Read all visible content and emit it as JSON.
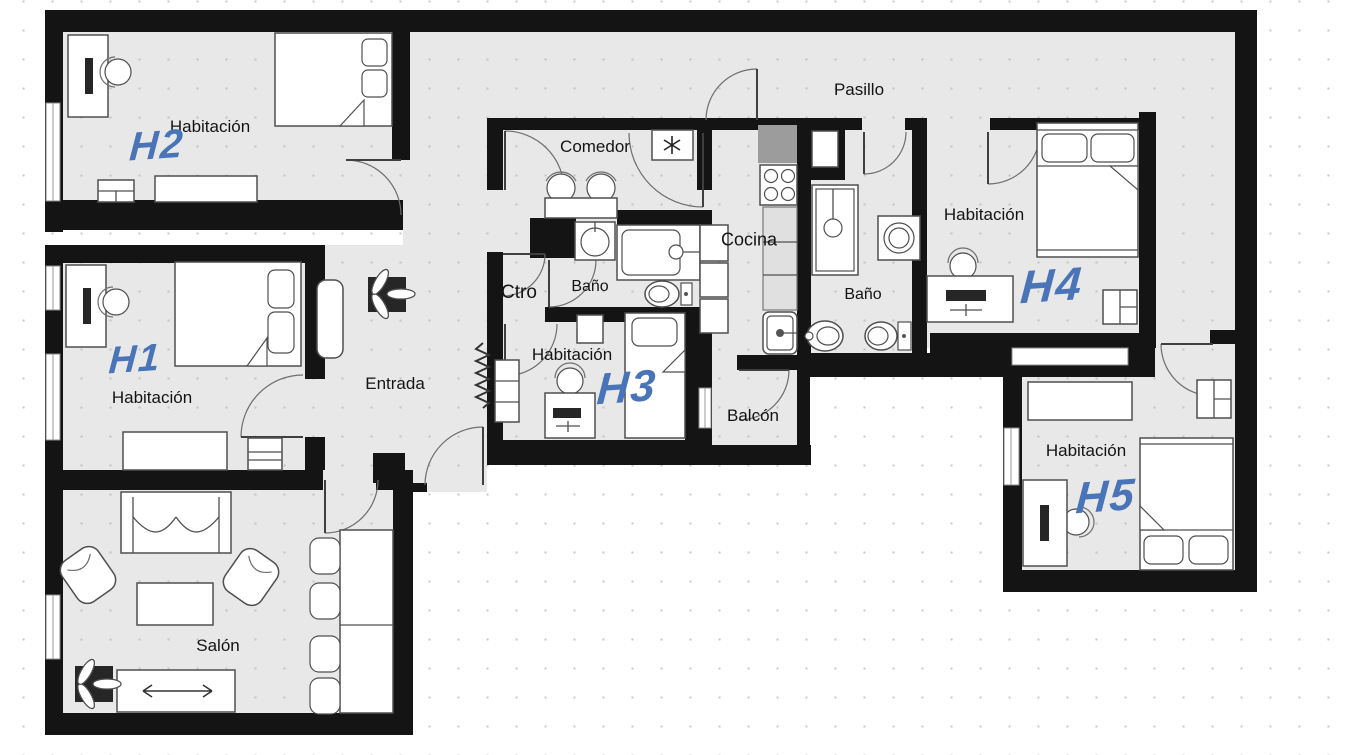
{
  "title": "Floor plan - shared apartment",
  "labels": {
    "pasillo": "Pasillo",
    "entrada": "Entrada",
    "salon": "Salón",
    "comedor": "Comedor",
    "ctro": "Ctro",
    "cocina": "Cocina",
    "balcon": "Balcón",
    "bano1": "Baño",
    "bano2": "Baño"
  },
  "rooms": {
    "h1": {
      "label": "Habitación",
      "code": "H1"
    },
    "h2": {
      "label": "Habitación",
      "code": "H2"
    },
    "h3": {
      "label": "Habitación",
      "code": "H3"
    },
    "h4": {
      "label": "Habitación",
      "code": "H4"
    },
    "h5": {
      "label": "Habitación",
      "code": "H5"
    }
  },
  "icons": {
    "ac_unit": "snowflake-icon",
    "plant": "plant-icon",
    "radiator": "radiator-icon"
  },
  "colors": {
    "wall": "#141414",
    "floor": "#e8e8e8",
    "room_code_blue": "#4a74b8",
    "background": "#ffffff"
  }
}
